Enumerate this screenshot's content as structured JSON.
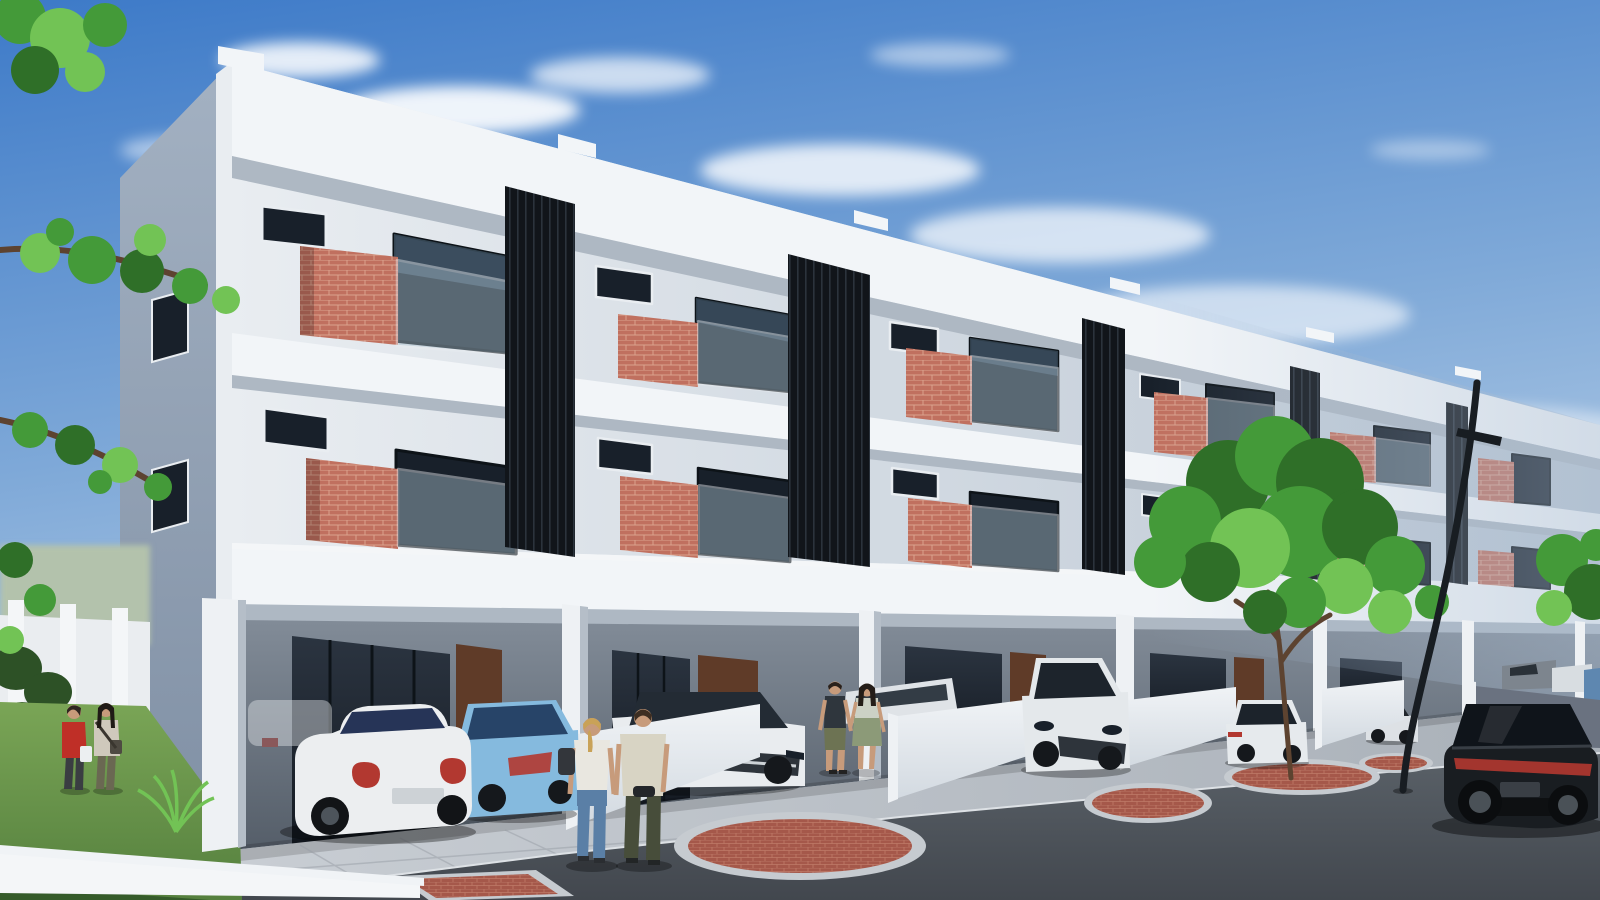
{
  "meta": {
    "title": "Modern three-storey townhouse development — exterior street rendering",
    "description": "Photorealistic architectural rendering of a row of modern three-storey terrace houses with red-brick balcony parapets, glass balcony railings, dark vertical louver screens, open carports with parked cars, low white driveway walls, pedestrians, street trees, red brick paving islands and a curved street lamp under a blue sky with clouds.",
    "width_px": 1600,
    "height_px": 900
  },
  "palette": {
    "skyTop": "#3d7ac8",
    "skyMid": "#7fa9d8",
    "skyLow": "#cbdcec",
    "cloud": "#ffffff",
    "facadeA": "#e9edf1",
    "facadeB": "#b9c5d2",
    "side1": "#a3b1c2",
    "side2": "#7e8ea3",
    "slab": "#f2f5f8",
    "slabLip": "#aeb8c3",
    "brick": "#c0705f",
    "brickLine": "#daa28e",
    "louver": "#11151a",
    "louverLine": "#2b333c",
    "glassTop": "#2b3440",
    "glassBot": "#141a22",
    "glassDark": "#18202a",
    "glassRefl": "#7fa2c0",
    "railGlass": "#a9bfcc",
    "frame": "#e9edf1",
    "glassFrame": "#0d1318",
    "recess1": "#828c98",
    "recess2": "#555e69",
    "recessWall": "#9aa4af",
    "door": "#5f3b28",
    "column": "#eef1f4",
    "columnShade": "#b5bec8",
    "wall1": "#f0f3f6",
    "wall2": "#d3dae1",
    "wallDark": "#6a7280",
    "drive1": "#c9ced4",
    "drive2": "#a9b0b8",
    "curb": "#dde1e5",
    "joint": "#979ea6",
    "road1": "#5a6168",
    "road2": "#42474e",
    "paveBrick": "#a5584a",
    "paveLine": "#bf7b68",
    "paveRing": "#c6cbd0",
    "grass1": "#7aa556",
    "grass2": "#55803e",
    "hedge": "#2d5126",
    "distGreen": "#b3c2ac",
    "fence": "#eaedf0",
    "leaf": "#449a39",
    "leafLight": "#72c355",
    "leafDark": "#2f6f28",
    "trunk": "#5d4330",
    "pole": "#181d22",
    "skin": "#c79b7b",
    "tail": "#b23830",
    "chrome": "#cdd2d6",
    "haze": "#a9bcd2"
  },
  "scene": {
    "building": {
      "storeys": 3,
      "visible_units": 6,
      "features": [
        "roof-parapet",
        "white-floor-slabs",
        "brick-balcony-parapets",
        "glass-balcony-railings",
        "dark-louver-screens",
        "awning-windows",
        "full-height-sliding-windows",
        "open-carports",
        "timber-entry-doors",
        "white-columns",
        "low-partition-walls"
      ]
    },
    "cars": [
      {
        "name": "white-coupe-foreground",
        "color": "#eceef0",
        "glass": "#263457"
      },
      {
        "name": "light-blue-sedan",
        "color": "#85bade",
        "glass": "#274468"
      },
      {
        "name": "white-sedan-front",
        "color": "#e9ecef",
        "glass": "#232b34"
      },
      {
        "name": "white-suv",
        "color": "#e4e8eb",
        "glass": "#1d242c"
      },
      {
        "name": "white-fastback-sedan",
        "color": "#e6eaed",
        "glass": "#1c232b"
      },
      {
        "name": "silver-sports-coupe",
        "color": "#dde1e5",
        "glass": "#20262d"
      },
      {
        "name": "grey-pickup-far",
        "color": "#7d858e",
        "glass": "#2a3138"
      },
      {
        "name": "white-car-far",
        "color": "#d8dde1",
        "glass": "#2a3138"
      },
      {
        "name": "blue-car-far",
        "color": "#5e87b0",
        "glass": "#22303e"
      },
      {
        "name": "black-suv-foreground",
        "color": "#191d21",
        "glass": "#0f141a",
        "accent": "#383e45"
      },
      {
        "name": "white-car-behind-wall",
        "color": "#dfe3e7",
        "glass": "#333c45"
      }
    ],
    "people": [
      {
        "name": "woman-red-jacket",
        "top": "#bf2f27",
        "bottom": "#3a3d42",
        "hair": "#2e2620",
        "accessory": "#eceff1"
      },
      {
        "name": "woman-beige-top",
        "top": "#cfc9bc",
        "bottom": "#6a6852",
        "hair": "#1f1a16",
        "accessory": "#4e4a42"
      },
      {
        "name": "man-dark-tank-shorts",
        "top": "#2f363d",
        "bottom": "#6d7353",
        "hair": "#2a211b"
      },
      {
        "name": "woman-green-dress",
        "top": "#ccd1c5",
        "bottom": "#8c9a78",
        "hair": "#241d18"
      },
      {
        "name": "woman-white-tank-jeans",
        "top": "#e9e7e0",
        "bottom": "#5a7fa6",
        "hair": "#c9a257",
        "accessory": "#33363b"
      },
      {
        "name": "man-cream-tshirt",
        "top": "#d8d4c4",
        "bottom": "#474d3a",
        "hair": "#3d2e22",
        "accessory": "#23262a"
      }
    ],
    "street": {
      "elements": [
        "asphalt-road",
        "concrete-driveways",
        "kerb",
        "brick-paving-islands",
        "street-lamp",
        "street-trees",
        "front-lawn",
        "hedge",
        "white-fence"
      ]
    }
  }
}
